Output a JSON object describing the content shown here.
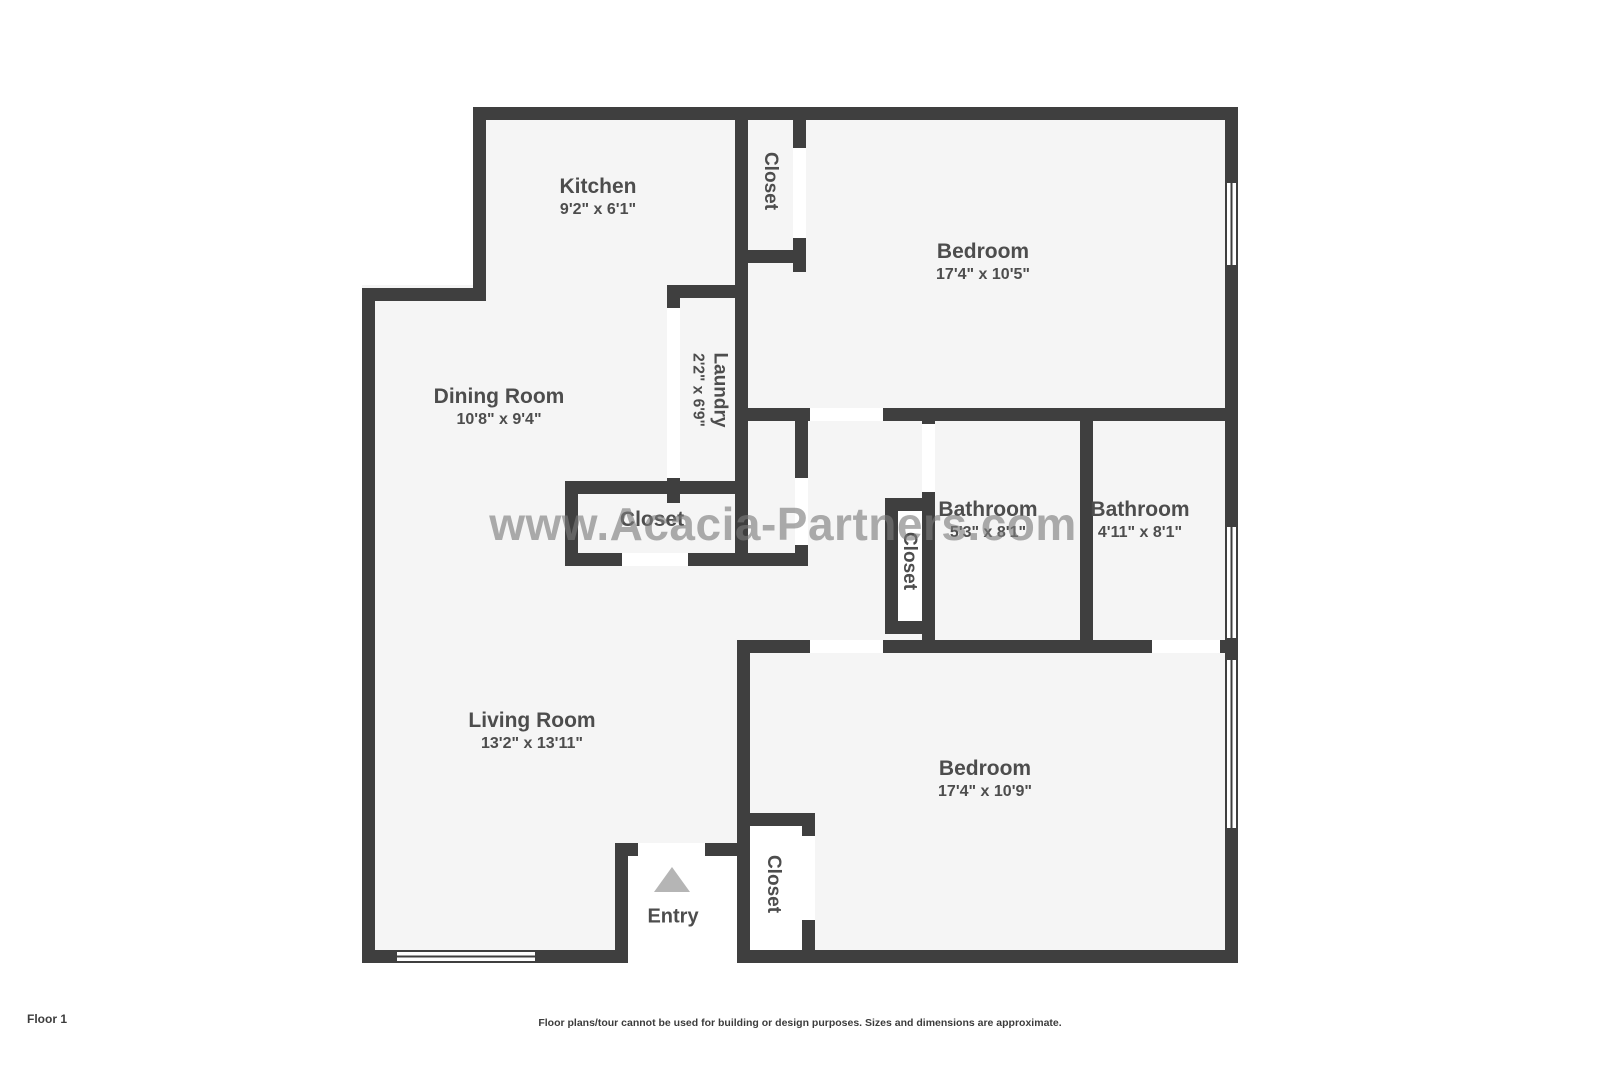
{
  "rooms": {
    "kitchen": {
      "name": "Kitchen",
      "dims": "9'2\" x 6'1\""
    },
    "bedroom_top": {
      "name": "Bedroom",
      "dims": "17'4\" x 10'5\""
    },
    "dining_room": {
      "name": "Dining Room",
      "dims": "10'8\" x 9'4\""
    },
    "laundry": {
      "name": "Laundry",
      "dims": "2'2\" x 6'9\""
    },
    "bathroom_1": {
      "name": "Bathroom",
      "dims": "5'3\" x 8'1\""
    },
    "bathroom_2": {
      "name": "Bathroom",
      "dims": "4'11\" x 8'1\""
    },
    "living_room": {
      "name": "Living Room",
      "dims": "13'2\" x 13'11\""
    },
    "bedroom_bottom": {
      "name": "Bedroom",
      "dims": "17'4\" x 10'9\""
    },
    "closet_top": {
      "name": "Closet"
    },
    "closet_hall": {
      "name": "Closet"
    },
    "closet_bath": {
      "name": "Closet"
    },
    "closet_bedroom": {
      "name": "Closet"
    },
    "entry": {
      "name": "Entry"
    }
  },
  "watermark": "www.Acacia-Partners.com",
  "footer": {
    "floor_label": "Floor 1",
    "disclaimer": "Floor plans/tour cannot be used for building or design purposes. Sizes and dimensions are approximate."
  },
  "colors": {
    "wall": "#3f3f3f",
    "floor": "#f5f5f5",
    "label": "#4d4d4d",
    "watermark": "#7b7b7b",
    "entry_arrow": "#b5b5b5"
  }
}
